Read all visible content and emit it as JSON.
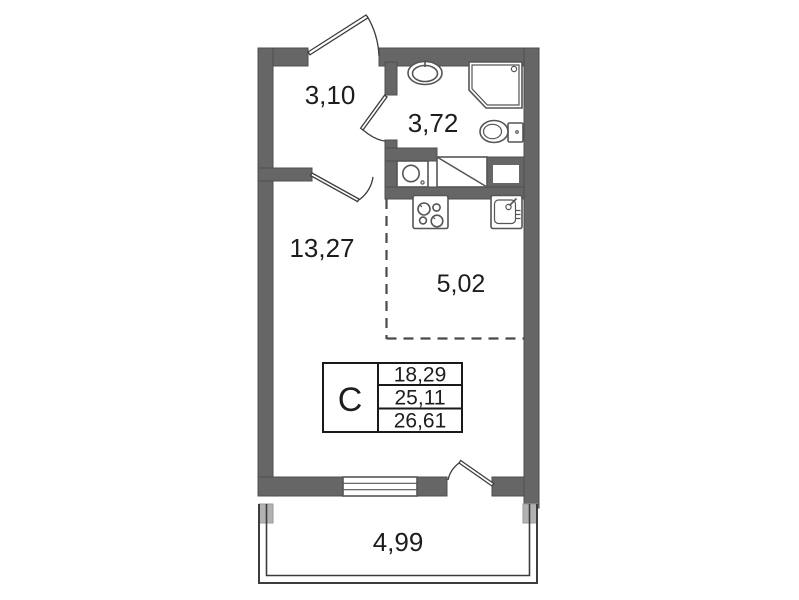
{
  "floorplan": {
    "area_table": {
      "type": "С",
      "values": [
        "18,29",
        "25,11",
        "26,61"
      ]
    },
    "rooms": [
      {
        "id": "hallway",
        "area": "3,10"
      },
      {
        "id": "bathroom",
        "area": "3,72"
      },
      {
        "id": "living-room",
        "area": "13,27"
      },
      {
        "id": "kitchen-zone",
        "area": "5,02"
      },
      {
        "id": "balcony",
        "area": "4,99"
      }
    ]
  },
  "theme": {
    "wall": "#666666",
    "wall-edge": "#4f4f4f",
    "light-wall": "#b2b2b2",
    "line": "#3d3d3d",
    "fixture": "#555555",
    "text": "#1d1d1d",
    "bg": "#ffffff",
    "dash": "#4a4a4a"
  }
}
